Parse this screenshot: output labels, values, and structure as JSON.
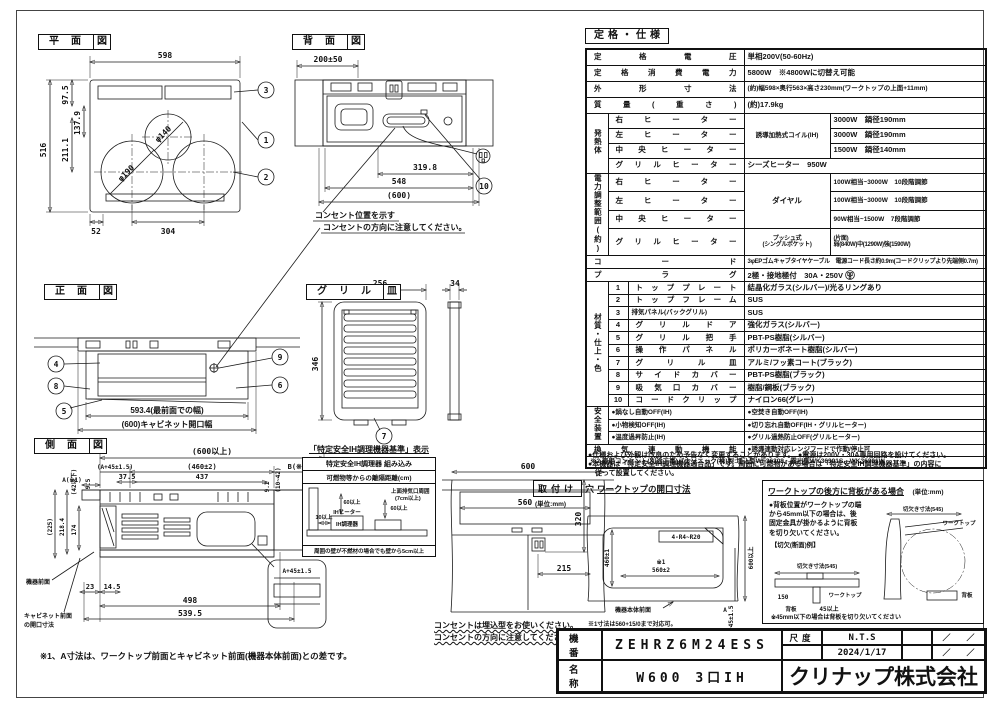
{
  "plan": {
    "t": "平面",
    "ts": "図",
    "w": "598",
    "h": "516",
    "d97": "97.5",
    "d137": "137.9",
    "d211": "211.1",
    "d52": "52",
    "d304": "304",
    "phi_c": "φ140",
    "phi_l": "φ190",
    "c1": "1",
    "c2": "2",
    "c3": "3"
  },
  "rear": {
    "t": "背面",
    "ts": "図",
    "d200": "200±50",
    "d319": "319.8",
    "d548": "548",
    "d600": "(600)",
    "c10": "10",
    "note1": "コンセント位置を示す",
    "note2": "コンセントの方向に注意してください。"
  },
  "front": {
    "t": "正面",
    "ts": "図",
    "d593": "593.4(最前面での幅)",
    "d600": "(600)キャビネット開口幅",
    "c4": "4",
    "c8": "8",
    "c5": "5",
    "c9": "9",
    "c6": "6"
  },
  "grill": {
    "t": "グリル",
    "ts": "皿",
    "d256": "256",
    "d346": "346",
    "d34": "34",
    "c7": "7"
  },
  "side": {
    "t": "側面",
    "ts": "図",
    "d600": "(600以上)",
    "da45": "(A+45±1.5)",
    "d460": "(460±2)",
    "db": "B(※2)",
    "da": "A(※1)",
    "d375": "37.5",
    "d437": "437",
    "d95": "9.5",
    "d42": "(42以下)",
    "d225": "(225)",
    "d218": "218.4",
    "d174": "174",
    "d23": "23",
    "d145": "14.5",
    "d498": "498",
    "d5395": "539.5",
    "d91": "9.1",
    "d1042": "(10~42)",
    "front_label": "機器前面",
    "cab1": "キャビネット前面",
    "cab2": "の開口寸法",
    "bubble": "A+45±1.5",
    "note": "※1、A寸法は、ワークトップ前面とキャビネット前面(機器本体前面)との差です。"
  },
  "safety_box": {
    "heading": "「特定安全IH調理機器基準」表示",
    "h1": "特定安全IH調理器 組み込み",
    "h2": "可燃物等からの離隔距離(cm)",
    "l1": "上面排気口周囲",
    "l2": "(7cm以上)",
    "l3": "60以上",
    "l4": "60以上",
    "l5": "IHヒーター",
    "l6": "10以上",
    "l7": "IH調理器",
    "foot": "周囲の壁が不燃材の場合でも壁から5cm以上"
  },
  "cabinet": {
    "d600": "600",
    "d560": "560",
    "d320": "320",
    "d215": "215",
    "note1": "コンセントは埋込型をお使いください。",
    "note2": "コンセントの方向に注意してください。"
  },
  "cutout": {
    "t": "取付け",
    "ts": "穴",
    "heading": "ワークトップの開口寸法",
    "unit": "(単位:mm)",
    "r": "4-R4~R20",
    "d460": "460±1",
    "dref": "※1",
    "d560": "560±2",
    "d600": "600以上",
    "da45": "A+45±1.5",
    "da": "A",
    "front_label": "機器本体前面",
    "note": "※1寸法は560+15/0まで対応可。"
  },
  "backboard": {
    "title": "ワークトップの後方に背板がある場合",
    "unit": "(単位:mm)",
    "b1": "●背板位置がワークトップの端",
    "b2": "から45mm以下の場合は、後",
    "b3": "固定金具が掛かるように背板",
    "b4": "を切り欠いてください。",
    "ex": "【切欠(断面)例】",
    "cut1": "切欠き寸法(545)",
    "cut2": "切欠き寸法(545)",
    "wt1": "ワークトップ",
    "wt2": "ワークトップ",
    "bb1": "背板",
    "bb2": "背板",
    "d45": "45以上",
    "d150": "150",
    "foot": "※45mm以下の場合は背板を切り欠いてください"
  },
  "spec": {
    "heading": "定格・仕様",
    "rows": [
      {
        "label": "定格電圧",
        "value": "単相200V(50-60Hz)"
      },
      {
        "label": "定格消費電力",
        "value": "5800W　※4800Wに切替え可能"
      },
      {
        "label": "外形寸法",
        "value": "(約)幅598×奥行563×高さ230mm(ワークトップの上面+11mm)"
      },
      {
        "label": "質量(重さ)",
        "value": "(約)17.9kg"
      }
    ],
    "heat": {
      "group": "発熱体",
      "mid": "誘導加熱式コイル(IH)",
      "r1": {
        "label": "右ヒーター",
        "value": "3000W　鍋径190mm"
      },
      "r2": {
        "label": "左ヒーター",
        "value": "3000W　鍋径190mm"
      },
      "r3": {
        "label": "中央ヒーター",
        "value": "1500W　鍋径140mm"
      },
      "r4": {
        "label": "グリルヒーター",
        "value": "シーズヒーター　950W"
      }
    },
    "power": {
      "group": "電力調整範囲(約)",
      "mid": "ダイヤル",
      "r1": {
        "label": "右ヒーター",
        "value": "100W相当~3000W　10段階調節"
      },
      "r2": {
        "label": "左ヒーター",
        "value": "100W相当~3000W　10段階調節"
      },
      "r3": {
        "label": "中央ヒーター",
        "value": "90W相当~1500W　7段階調節"
      },
      "r4": {
        "label": "グリルヒーター",
        "mid1": "プッシュ式",
        "mid2": "(シングルポケット)",
        "val1": "(片面)",
        "val2": "弱(840W)中(1290W)強(1590W)"
      }
    },
    "cord": {
      "label": "コード",
      "value": "3φEPゴムキャブタイヤケーブル　電源コード長さ約0.9m(コードクリップより先端側0.7m)"
    },
    "plug": {
      "label": "プラグ",
      "value": "2極・接地極付　30A・250V"
    },
    "materials": {
      "group": "材質・仕上・色",
      "items": [
        {
          "no": "1",
          "name": "トッププレート",
          "value": "結晶化ガラス(シルバー)/光るリングあり"
        },
        {
          "no": "2",
          "name": "トップフレーム",
          "value": "SUS"
        },
        {
          "no": "3",
          "name": "排気パネル(バックグリル)",
          "value": "SUS"
        },
        {
          "no": "4",
          "name": "グリルドア",
          "value": "強化ガラス(シルバー)"
        },
        {
          "no": "5",
          "name": "グリル把手",
          "value": "PBT-PS樹脂(シルバー)"
        },
        {
          "no": "6",
          "name": "操作パネル",
          "value": "ポリカーボネート樹脂(シルバー)"
        },
        {
          "no": "7",
          "name": "グリル皿",
          "value": "アルミ/フッ素コート(ブラック)"
        },
        {
          "no": "8",
          "name": "サイドカバー",
          "value": "PBT-PS樹脂(ブラック)"
        },
        {
          "no": "9",
          "name": "吸気口カバー",
          "value": "樹脂/鋼板(ブラック)"
        },
        {
          "no": "10",
          "name": "コードクリップ",
          "value": "ナイロン66(グレー)"
        }
      ]
    },
    "safety": {
      "group": "安全装置",
      "left": [
        "●鍋なし自動OFF(IH)",
        "●小物検知OFF(IH)",
        "●温度過昇防止(IH)"
      ],
      "right": [
        "●空焚き自動OFF(IH)",
        "●切り忘れ自動OFF(IH・グリルヒーター)",
        "●グリル過熱防止OFF(グリルヒーター)"
      ]
    },
    "vent": {
      "label": "換気連動機能",
      "value": "●誘導連動対応レンジフードで作動/停止可"
    },
    "outlet": "※2 専用コンセント(別途工事)パナソニック(株)製:埋込型WF36308、露出型WK36301S、WK36301W",
    "notes": [
      "●仕様および外観は改良のため予告なく変更することがあります。　●電源は200V・30A専用回路を設けてください。",
      "●本機器は「特定安全IH調理機器適合品」です。周囲に可燃物がある場合は「特定安全IH調理機器基準」の内容に",
      "　従って設置してください。"
    ]
  },
  "titleblock": {
    "model_label": "機番",
    "model": "ZEHRZ6M24ESS",
    "name_label": "名称",
    "name": "W600 3口IH",
    "scale_label": "尺度",
    "scale": "N.T.S",
    "date": "2024/1/17",
    "rev1": "／　　／",
    "rev2": "／　　／",
    "company": "クリナップ株式会社"
  }
}
